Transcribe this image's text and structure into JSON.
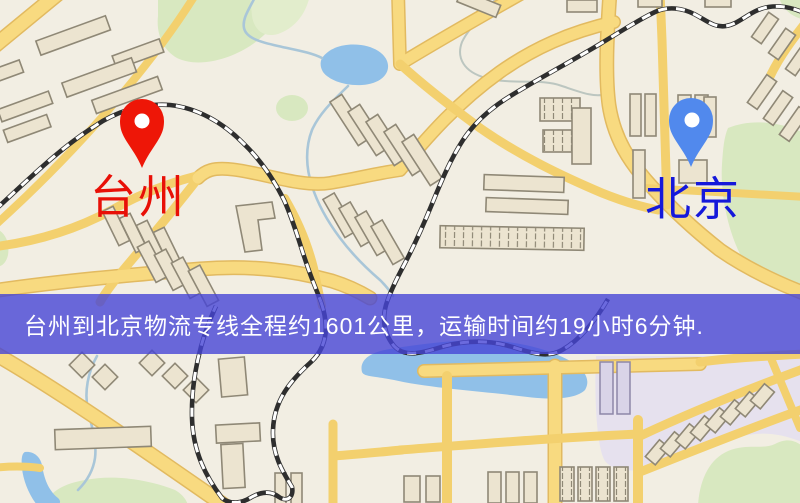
{
  "map": {
    "origin": {
      "label": "台州",
      "pin_icon": "red-map-pin"
    },
    "destination": {
      "label": "北京",
      "pin_icon": "blue-map-pin"
    }
  },
  "banner": {
    "text": "台州到北京物流专线全程约1601公里，运输时间约19小时6分钟."
  },
  "route": {
    "distance_km": 1601,
    "duration_hours": 19,
    "duration_minutes": 6
  },
  "colors": {
    "banner_bg": "rgba(70,69,214,0.80)",
    "banner_text": "#ffffff",
    "origin_pin": "#ee1607",
    "origin_label": "#e81007",
    "destination_pin": "#5189ed",
    "destination_label": "#1518da",
    "map_bg": "#f2eee3",
    "road_fill": "#f8da80",
    "road_casing": "#e2ba60",
    "water": "#90c0e8",
    "green": "#d8e8c0",
    "building_fill": "#ece4d0",
    "building_stroke": "#8f8876",
    "railway_dark": "#2e2e2e",
    "district_lavender": "#e6e1ee"
  }
}
